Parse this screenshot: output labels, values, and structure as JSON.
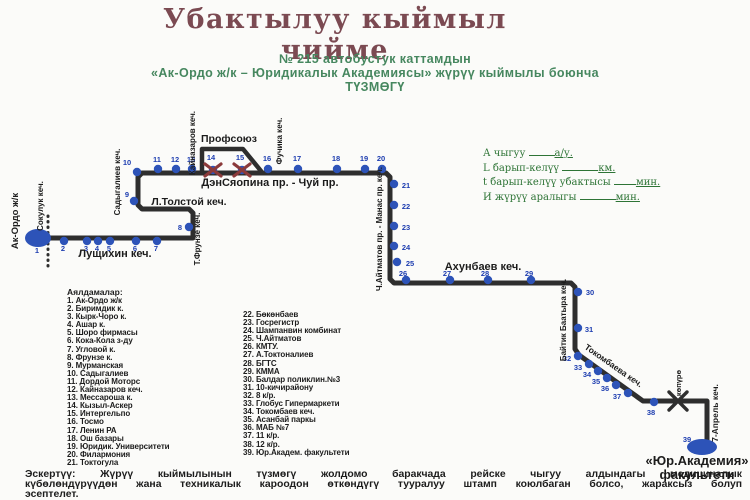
{
  "title": {
    "line1": "Убактылуу кыймыл",
    "line2": "чийме"
  },
  "subtitle": {
    "line1": "№ 215 автобустук каттамдын",
    "line2": "«Ак-Ордо ж/к – Юридикалык Академиясы» жүрүү кыймылы боюнча",
    "line3": "ТҮЗМӨГҮ"
  },
  "annotations": [
    {
      "label": "А чыгуу",
      "unit": "а/у.",
      "blank": 26
    },
    {
      "label": "L барып-келүү",
      "unit": "км.",
      "blank": 36
    },
    {
      "label": "t барып-келүү убактысы",
      "unit": "мин.",
      "blank": 22
    },
    {
      "label": "И жүрүү аралыгы",
      "unit": "мин.",
      "blank": 36
    }
  ],
  "legend": {
    "header": "Аялдамалар:",
    "col1": [
      "1. Ак-Ордо ж/к",
      "2. Биримдик к.",
      "3. Кырк-Чоро к.",
      "4. Ашар к.",
      "5. Шоро фирмасы",
      "6. Кока-Кола з-ду",
      "7. Угловой к.",
      "8. Фрунзе к.",
      "9. Мурманская",
      "10. Садыгалиев",
      "11. Дордой Моторс",
      "12. Кайназаров кеч.",
      "13. Мессароша к.",
      "14. Кызыл-Аскер",
      "15. Интергельпо",
      "16. Тосмо",
      "17. Ленин РА",
      "18. Ош базары",
      "19. Юридик. Университети",
      "20. Филармония",
      "21. Токтогула"
    ],
    "col2": [
      "22. Бөкөнбаев",
      "23. Госрегистр",
      "24. Шампанвин комбинат",
      "25. Ч.Айтматов",
      "26. КМТУ.",
      "27. А.Токтоналиев",
      "28. БГТС",
      "29. КММА",
      "30. Балдар поликлин.№3",
      "31. 10-кичирайону",
      "32. 8 к/р.",
      "33. Глобус Гипермаркети",
      "34. Токомбаев кеч.",
      "35. Асанбай паркы",
      "36. МАБ №7",
      "37. 11 к/р.",
      "38. 12 к/р.",
      "39. Юр.Академ. факультети"
    ]
  },
  "note": {
    "lines": [
      "Эскертүү: Жүрүү кыймылынын түзмөгү жолдомо баракчада рейске чыгуу алдындагы медициналык",
      "күбөлөндүрүүдөн жана техникалык кароодон өткөндүгү тууралуу штамп коюлбаган болсо, жараксыз болуп",
      "эсептелет."
    ]
  },
  "map": {
    "paths": {
      "main": "38,238 193,238 193,213 189,209 142,209 138,205 138,177 142,173 386,173 390,177 390,279 394,283 571,283 575,287 575,349 579,355 643,401 707,401 707,444",
      "detour": "202,171 202,149 243,149 261,171",
      "dotted": "48,216 48,266"
    },
    "stops": [
      {
        "n": "2",
        "x": 64,
        "y": 241,
        "nx": 63,
        "ny": 251
      },
      {
        "n": "3",
        "x": 87,
        "y": 241,
        "nx": 86,
        "ny": 251
      },
      {
        "n": "4",
        "x": 98,
        "y": 241,
        "nx": 97,
        "ny": 251
      },
      {
        "n": "5",
        "x": 110,
        "y": 241,
        "nx": 109,
        "ny": 251
      },
      {
        "n": "6",
        "x": 136,
        "y": 241,
        "nx": 135,
        "ny": 251
      },
      {
        "n": "7",
        "x": 157,
        "y": 241,
        "nx": 156,
        "ny": 251
      },
      {
        "n": "8",
        "x": 189,
        "y": 227,
        "nx": 180,
        "ny": 230
      },
      {
        "n": "9",
        "x": 134,
        "y": 201,
        "nx": 127,
        "ny": 197
      },
      {
        "n": "10",
        "x": 137,
        "y": 172,
        "nx": 127,
        "ny": 165
      },
      {
        "n": "11",
        "x": 158,
        "y": 169,
        "nx": 157,
        "ny": 162
      },
      {
        "n": "12",
        "x": 176,
        "y": 169,
        "nx": 175,
        "ny": 162
      },
      {
        "n": "13",
        "x": 192,
        "y": 169,
        "nx": 191,
        "ny": 162
      },
      {
        "n": "14",
        "x": 213,
        "y": 170,
        "nx": 211,
        "ny": 160,
        "closed": true
      },
      {
        "n": "15",
        "x": 242,
        "y": 170,
        "nx": 240,
        "ny": 160,
        "closed": true
      },
      {
        "n": "16",
        "x": 268,
        "y": 169,
        "nx": 267,
        "ny": 161
      },
      {
        "n": "17",
        "x": 298,
        "y": 169,
        "nx": 297,
        "ny": 161
      },
      {
        "n": "18",
        "x": 337,
        "y": 169,
        "nx": 336,
        "ny": 161
      },
      {
        "n": "19",
        "x": 365,
        "y": 169,
        "nx": 364,
        "ny": 161
      },
      {
        "n": "20",
        "x": 382,
        "y": 169,
        "nx": 381,
        "ny": 161
      },
      {
        "n": "21",
        "x": 394,
        "y": 184,
        "nx": 406,
        "ny": 188
      },
      {
        "n": "22",
        "x": 394,
        "y": 205,
        "nx": 406,
        "ny": 209
      },
      {
        "n": "23",
        "x": 394,
        "y": 226,
        "nx": 406,
        "ny": 230
      },
      {
        "n": "24",
        "x": 394,
        "y": 246,
        "nx": 406,
        "ny": 250
      },
      {
        "n": "25",
        "x": 397,
        "y": 262,
        "nx": 410,
        "ny": 266
      },
      {
        "n": "26",
        "x": 406,
        "y": 280,
        "nx": 403,
        "ny": 276
      },
      {
        "n": "27",
        "x": 450,
        "y": 280,
        "nx": 447,
        "ny": 276
      },
      {
        "n": "28",
        "x": 488,
        "y": 280,
        "nx": 485,
        "ny": 276
      },
      {
        "n": "29",
        "x": 531,
        "y": 280,
        "nx": 529,
        "ny": 276
      },
      {
        "n": "30",
        "x": 578,
        "y": 292,
        "nx": 590,
        "ny": 295
      },
      {
        "n": "31",
        "x": 578,
        "y": 328,
        "nx": 589,
        "ny": 332
      },
      {
        "n": "32",
        "x": 578,
        "y": 356,
        "nx": 567,
        "ny": 361
      },
      {
        "n": "33",
        "x": 589,
        "y": 364,
        "nx": 578,
        "ny": 370
      },
      {
        "n": "34",
        "x": 598,
        "y": 371,
        "nx": 587,
        "ny": 377
      },
      {
        "n": "35",
        "x": 607,
        "y": 378,
        "nx": 596,
        "ny": 384
      },
      {
        "n": "36",
        "x": 616,
        "y": 385,
        "nx": 605,
        "ny": 391
      },
      {
        "n": "37",
        "x": 628,
        "y": 393,
        "nx": 617,
        "ny": 399
      },
      {
        "n": "38",
        "x": 654,
        "y": 402,
        "nx": 651,
        "ny": 415
      }
    ],
    "terminals": [
      {
        "n": "1",
        "x": 38,
        "y": 238,
        "rx": 13,
        "ry": 9,
        "nx": 37,
        "ny": 253
      },
      {
        "n": "39",
        "x": 702,
        "y": 447,
        "rx": 15,
        "ry": 8,
        "nx": 687,
        "ny": 442
      }
    ],
    "streets": [
      {
        "t": "Ак-Ордо ж/к",
        "x": 18,
        "y": 221,
        "r": -90,
        "fs": 9.5
      },
      {
        "t": "Сокулук кеч.",
        "x": 43,
        "y": 206,
        "r": -90,
        "fs": 8
      },
      {
        "t": "Лущихин кеч.",
        "x": 115,
        "y": 257,
        "r": 0,
        "fs": 11
      },
      {
        "t": "Т.Фрунзе кеч.",
        "x": 200,
        "y": 239,
        "r": -90,
        "fs": 8
      },
      {
        "t": "Л.Толстой кеч.",
        "x": 189,
        "y": 205,
        "r": 0,
        "fs": 10.5
      },
      {
        "t": "Садыгалиев кеч.",
        "x": 120,
        "y": 182,
        "r": -90,
        "fs": 8
      },
      {
        "t": "Кайназаров кеч.",
        "x": 195,
        "y": 143,
        "r": -90,
        "fs": 8
      },
      {
        "t": "Профсоюз",
        "x": 229,
        "y": 142,
        "r": 0,
        "fs": 10.5
      },
      {
        "t": "Фучика кеч.",
        "x": 282,
        "y": 141,
        "r": -90,
        "fs": 8
      },
      {
        "t": "ДэнСяопина пр. - Чуй пр.",
        "x": 270,
        "y": 186,
        "r": 0,
        "fs": 11
      },
      {
        "t": "Ч.Айтматов пр. - Манас пр. кеч.",
        "x": 382,
        "y": 229,
        "r": -90,
        "fs": 8
      },
      {
        "t": "Ахунбаев кеч.",
        "x": 483,
        "y": 270,
        "r": 0,
        "fs": 11
      },
      {
        "t": "Байтик Баатыра кеч.",
        "x": 566,
        "y": 320,
        "r": -90,
        "fs": 8
      },
      {
        "t": "Токомбаева кеч.",
        "x": 612,
        "y": 368,
        "r": 35,
        "fs": 8.5
      },
      {
        "t": "көпүрө",
        "x": 681,
        "y": 383,
        "r": -90,
        "fs": 7.5
      },
      {
        "t": "7-Апрель кеч.",
        "x": 718,
        "y": 413,
        "r": -90,
        "fs": 8.5
      }
    ],
    "bridge": {
      "x": 678,
      "y": 401
    },
    "end_label": {
      "line1": "«Юр.Академия»",
      "line2": "факультети",
      "x": 697,
      "y1": 465,
      "y2": 479
    }
  },
  "colors": {
    "title": "#7b4a52",
    "green": "#46875f",
    "anngreen": "#2e7436",
    "text": "#1c1c1c",
    "route": "#2e2e2e",
    "stop_blue": "#2d53b8",
    "number_blue": "#1d3db0",
    "closed_red": "#8b3a3a"
  }
}
